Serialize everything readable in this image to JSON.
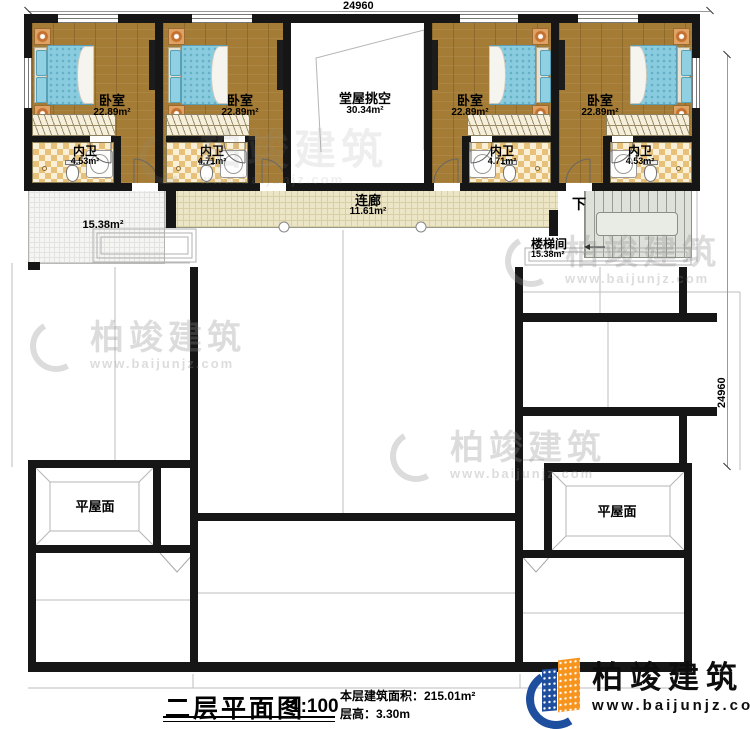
{
  "dimensions": {
    "top": "24960",
    "right": "24960"
  },
  "rooms": {
    "bedrooms": [
      {
        "label": "卧室",
        "area": "22.89m²",
        "bath_label": "内卫",
        "bath_area": "4.53m²"
      },
      {
        "label": "卧室",
        "area": "22.89m²",
        "bath_label": "内卫",
        "bath_area": "4.71m²"
      },
      {
        "label": "卧室",
        "area": "22.89m²",
        "bath_label": "内卫",
        "bath_area": "4.71m²"
      },
      {
        "label": "卧室",
        "area": "22.89m²",
        "bath_label": "内卫",
        "bath_area": "4.53m²"
      }
    ],
    "hall": {
      "label": "堂屋挑空",
      "area": "30.34m²"
    },
    "corridor": {
      "label": "连廊",
      "area": "11.61m²"
    },
    "terrace": {
      "area": "15.38m²"
    },
    "stairwell": {
      "label": "楼梯间",
      "area": "15.38m²",
      "direction": "下"
    },
    "flat_roof_left": "平屋面",
    "flat_roof_right": "平屋面"
  },
  "title_block": {
    "title": "二层平面图",
    "scale": "1:100",
    "area_line": "本层建筑面积：215.01m²",
    "floor_height_line": "层高：3.30m"
  },
  "logo": {
    "name": "柏竣建筑",
    "url": "www.baijunjz.com"
  },
  "watermark": {
    "name": "柏竣建筑",
    "url": "www.baijunjz.com"
  },
  "colors": {
    "wall": "#161616",
    "wood": "#a57c36",
    "bath_tile": "#e7c17a",
    "corridor_tile": "#ece5c6",
    "stair": "#dde1d9",
    "bed": "#8accdf",
    "logo_blue": "#1e4e9e",
    "logo_orange": "#f7941d"
  }
}
